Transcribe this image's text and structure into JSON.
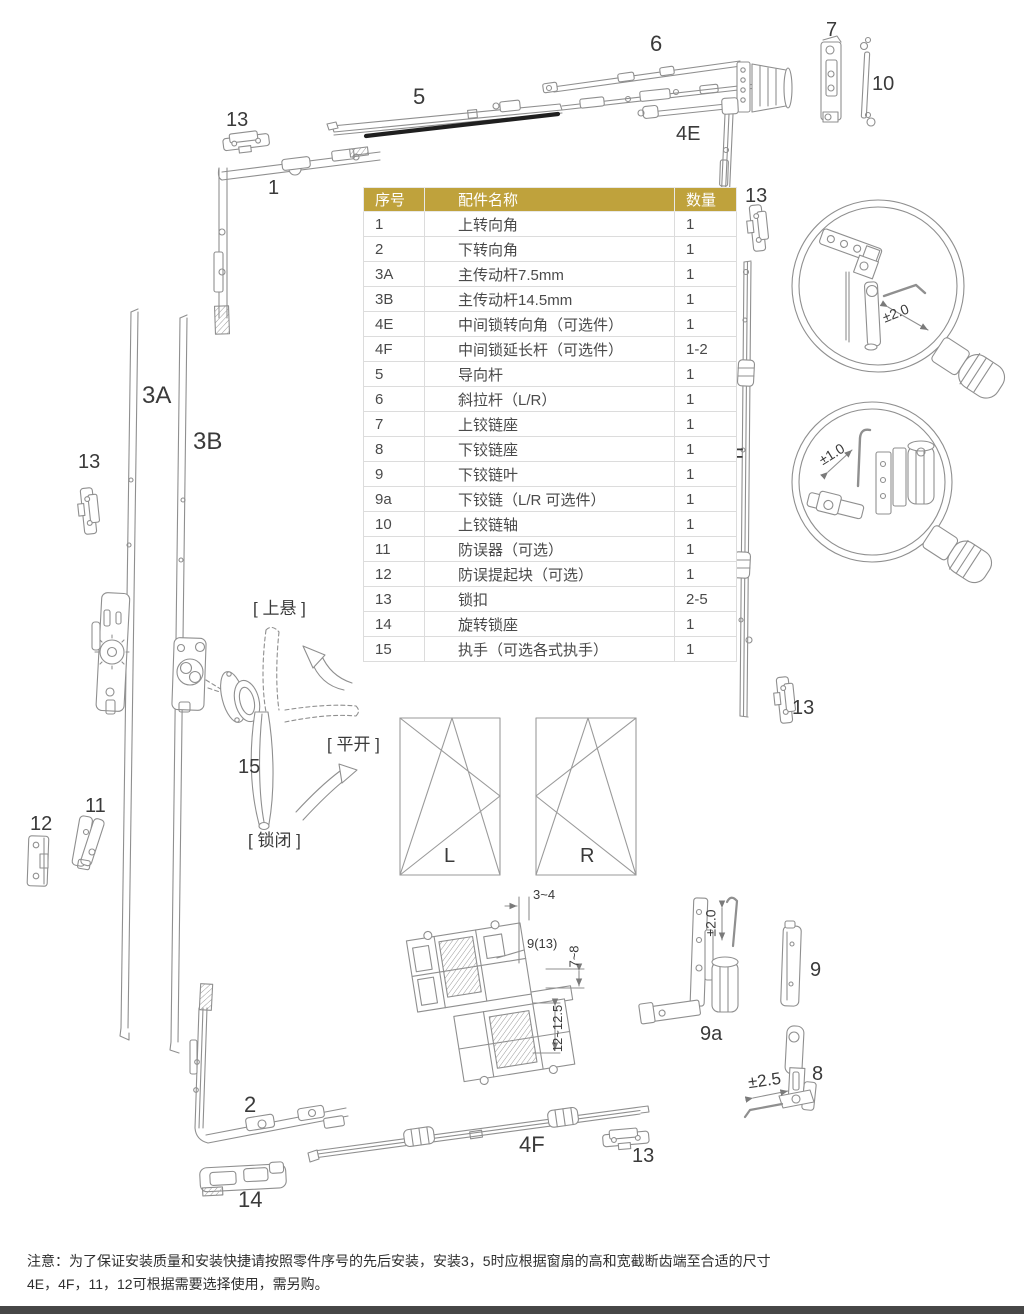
{
  "table": {
    "headers": [
      "序号",
      "配件名称",
      "数量"
    ],
    "rows": [
      [
        "1",
        "上转向角",
        "1"
      ],
      [
        "2",
        "下转向角",
        "1"
      ],
      [
        "3A",
        "主传动杆7.5mm",
        "1"
      ],
      [
        "3B",
        "主传动杆14.5mm",
        "1"
      ],
      [
        "4E",
        "中间锁转向角（可选件）",
        "1"
      ],
      [
        "4F",
        "中间锁延长杆（可选件）",
        "1-2"
      ],
      [
        "5",
        "导向杆",
        "1"
      ],
      [
        "6",
        "斜拉杆（L/R）",
        "1"
      ],
      [
        "7",
        "上铰链座",
        "1"
      ],
      [
        "8",
        "下铰链座",
        "1"
      ],
      [
        "9",
        "下铰链叶",
        "1"
      ],
      [
        "9a",
        "下铰链（L/R 可选件）",
        "1"
      ],
      [
        "10",
        "上铰链轴",
        "1"
      ],
      [
        "11",
        "防误器（可选）",
        "1"
      ],
      [
        "12",
        "防误提起块（可选）",
        "1"
      ],
      [
        "13",
        "锁扣",
        "2-5"
      ],
      [
        "14",
        "旋转锁座",
        "1"
      ],
      [
        "15",
        "执手（可选各式执手）",
        "1"
      ]
    ]
  },
  "labels": {
    "l13_top_left": "13",
    "l1": "1",
    "l5": "5",
    "l6": "6",
    "l4e": "4E",
    "l7": "7",
    "l10": "10",
    "l13_right_upper": "13",
    "l3a": "3A",
    "l3b": "3B",
    "l13_left": "13",
    "l4f_right": "4F",
    "l13_right_lower": "13",
    "l15": "15",
    "l11": "11",
    "l12": "12",
    "l2": "2",
    "l14": "14",
    "l4f_bottom": "4F",
    "l13_bottom": "13",
    "l9a": "9a",
    "l9": "9",
    "l8": "8",
    "window_left": "L",
    "window_right": "R"
  },
  "handle_positions": {
    "tilt": "[ 上悬 ]",
    "turn": "[ 平开 ]",
    "locked": "[ 锁闭 ]"
  },
  "annotations": {
    "profile_top_gap": "3~4",
    "profile_screw": "9(13)",
    "profile_right": "7~8",
    "profile_lower": "12~12.5",
    "magnifier_top_adjust": "±2.0",
    "magnifier_bottom_adjust": "±1.0",
    "hinge_9a_adjust": "±2.0",
    "hinge_8_adjust": "±2.5"
  },
  "note": {
    "line1": "注意：为了保证安装质量和安装快捷请按照零件序号的先后安装，安装3，5时应根据窗扇的高和宽截断齿端至合适的尺寸",
    "line2": "4E，4F，11，12可根据需要选择使用，需另购。"
  },
  "colors": {
    "table_header_bg": "#bfa23c",
    "table_header_text": "#ffffff",
    "line_art": "#8f8f8f",
    "label_text": "#3a3a3a",
    "dark_stripe": "#1f1f1f",
    "footer_bar": "#474747"
  }
}
